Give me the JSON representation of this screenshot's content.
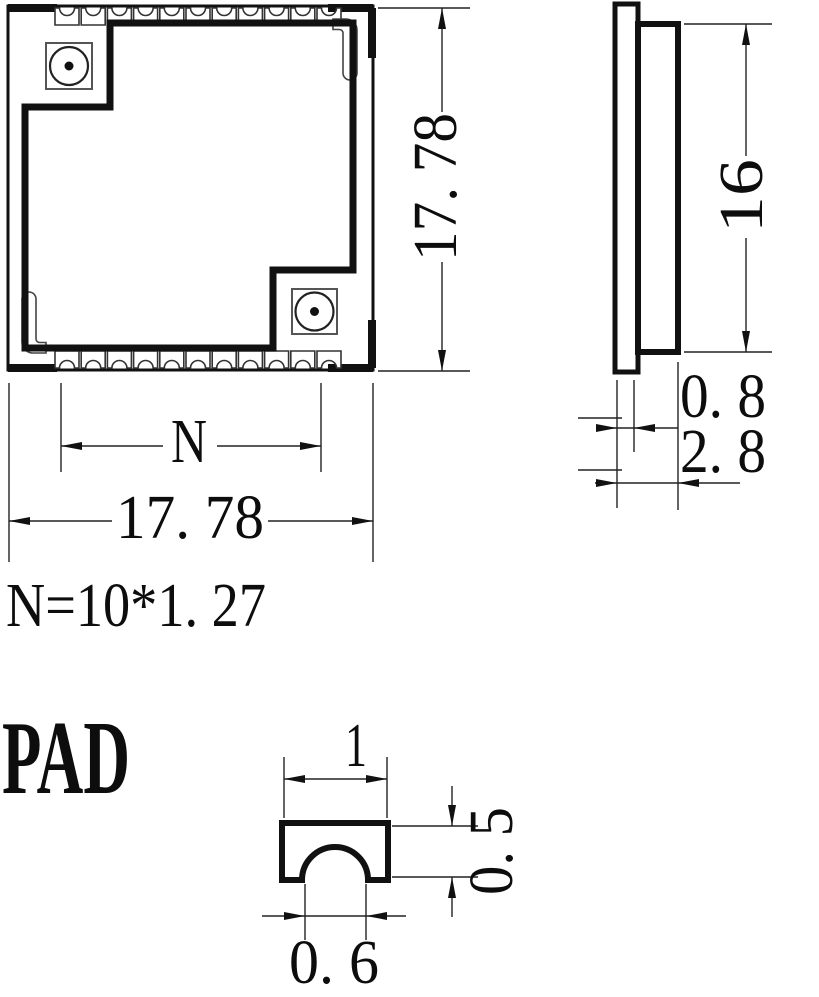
{
  "front_view": {
    "width_label": "17. 78",
    "height_label": "17. 78",
    "pad_span_label": "N",
    "pad_pitch_formula": "N=10*1. 27",
    "castellation_count": 11
  },
  "side_view": {
    "shield_height_label": "16",
    "pcb_thickness_label": "0. 8",
    "total_thickness_label": "2. 8"
  },
  "pad_detail": {
    "title": "PAD",
    "pad_width_label": "1",
    "pad_height_label": "0. 5",
    "notch_width_label": "0. 6"
  },
  "colors": {
    "line": "#111111",
    "background": "#ffffff"
  }
}
